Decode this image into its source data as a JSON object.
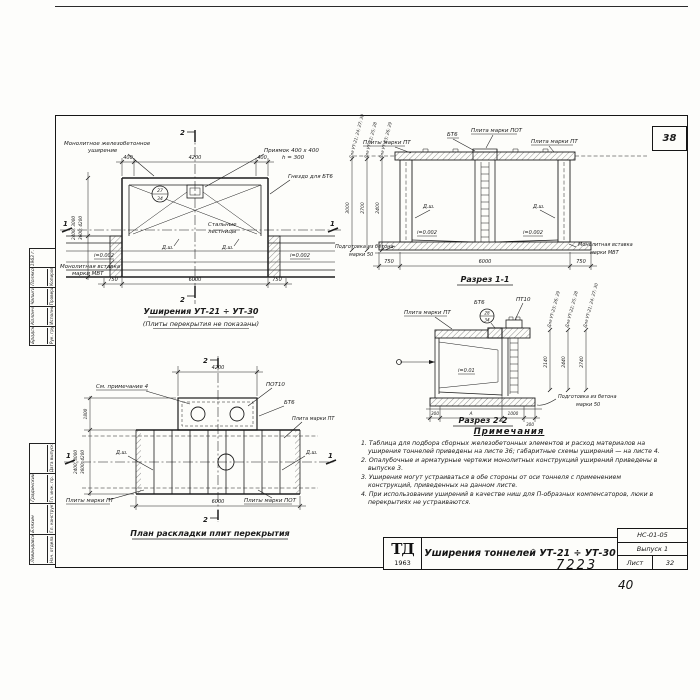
{
  "frame": {
    "page_number": "38",
    "doc_number": "7223",
    "inventory_number": "40"
  },
  "title_block": {
    "logo": "ТД",
    "logo_year": "1963",
    "title": "Уширения тоннелей УТ-21 ÷ УТ-30",
    "code": "НС-01-05",
    "issue": "Выпуск 1",
    "sheet_word": "Лист",
    "sheet_number": "32"
  },
  "stamps": {
    "upper": {
      "roles": [
        "Рук. группы",
        "Исполнитель",
        "Проверил",
        "Копировала"
      ],
      "names": [
        "Бродский",
        "Колончиков",
        "Чапыгин",
        "Полякова"
      ],
      "year": "1963 г."
    },
    "lower": {
      "roles": [
        "Нач. отдела",
        "Гл. конструктор",
        "Гл. инж. пр.",
        "Дата выпуска"
      ],
      "names": [
        "Левандовский",
        "Бляхин",
        "Градинский",
        ""
      ]
    }
  },
  "plan_top": {
    "section_mark_top": "2",
    "section_mark_bottom": "2",
    "section_mark_left": "1",
    "section_mark_right": "1",
    "label_monolithic_line1": "Монолитное железобетонное",
    "label_monolithic_line2": "уширение",
    "label_pit_line1": "Приямок 400 х 400",
    "label_pit_line2": "h = 300",
    "label_socket": "Гнездо для БТ6",
    "label_stairs_line1": "Стальные",
    "label_stairs_line2": "лестницы",
    "label_insert_line1": "Монолитная вставка",
    "label_insert_line2": "марки МВТ",
    "detail_mark_top": "27",
    "detail_mark_bottom": "34",
    "dim_top_left": "400",
    "dim_top_mid": "4200",
    "dim_top_right": "400",
    "dim_bottom_left": "750",
    "dim_bottom_mid": "6000",
    "dim_bottom_right": "750",
    "dim_side_line1": "2400; 3000",
    "dim_side_line2": "3600; 4200",
    "slope_left": "i=0.002",
    "slope_right": "i=0.002",
    "joint_left": "Д.ш.",
    "joint_right": "Д.ш.",
    "title": "Уширения УТ-21 ÷ УТ-30",
    "subtitle": "(Плиты перекрытия не показаны)"
  },
  "section_1": {
    "title": "Разрез 1-1",
    "label_pt_left": "Плиты марки ПТ",
    "label_bt6": "БТ6",
    "label_pot": "Плита марки ПОТ",
    "label_pt_right": "Плита марки ПТ",
    "label_base_line1": "Подготовка из бетона",
    "label_base_line2": "марки 50",
    "label_insert_line1": "Монолитная вставка",
    "label_insert_line2": "марки МВТ",
    "slope_left": "i=0.002",
    "slope_right": "i=0.002",
    "joint_left": "Д.ш.",
    "joint_right": "Д.ш.",
    "dim_bottom_left": "750",
    "dim_bottom_mid": "6000",
    "dim_bottom_right": "750",
    "heights": [
      "3000",
      "2700",
      "2400"
    ],
    "height_groups": [
      "Для УТ-21; 24; 27; 30",
      "Для УТ-22; 25; 28",
      "Для УТ-23; 26; 29"
    ]
  },
  "section_2": {
    "title": "Разрез 2-2",
    "label_pt": "Плита марки ПТ",
    "label_bt6": "БТ6",
    "label_pt10": "ПТ10",
    "detail_mark_top": "28",
    "detail_mark_bottom": "34",
    "slope": "i=0.01",
    "label_base_line1": "Подготовка из бетона",
    "label_base_line2": "марки 50",
    "dims_bottom": [
      "300",
      "А",
      "1000",
      "300"
    ],
    "heights": [
      "2140",
      "2440",
      "2740"
    ],
    "height_groups": [
      "Для УТ-23; 26; 29",
      "Для УТ-22; 25; 28",
      "Для УТ-21; 24; 27; 30"
    ]
  },
  "plan_bottom": {
    "section_mark_top": "2",
    "section_mark_bottom": "2",
    "section_mark_left": "1",
    "section_mark_right": "1",
    "label_note": "См. примечание 4",
    "label_pot10": "ПОТ10",
    "label_bt6": "БТ6",
    "label_pt": "Плита марки ПТ",
    "label_pt_plural": "Плиты марки ПТ",
    "label_pot_plural": "Плиты марки ПОТ",
    "joint_left": "Д.ш.",
    "joint_right": "Д.ш.",
    "dim_top": "4200",
    "dim_bottom": "6000",
    "dim_side": "1800",
    "dim_side_line1": "2400; 3000",
    "dim_side_line2": "3600; 4200",
    "title": "План раскладки плит перекрытия"
  },
  "notes": {
    "title": "Примечания",
    "items": [
      "1. Таблица для подбора сборных железобетонных элементов и расход материалов на уширения тоннелей приведены на листе 36; габаритные схемы уширений — на листе 4.",
      "2. Опалубочные и арматурные чертежи монолитных конструкций уширений приведены в выпуске 3.",
      "3. Уширения могут устраиваться в обе стороны от оси тоннеля с применением конструкций, приведенных на данном листе.",
      "4. При использовании уширений в качестве ниш для П-образных компенсаторов, люки в перекрытиях не устраиваются."
    ]
  }
}
